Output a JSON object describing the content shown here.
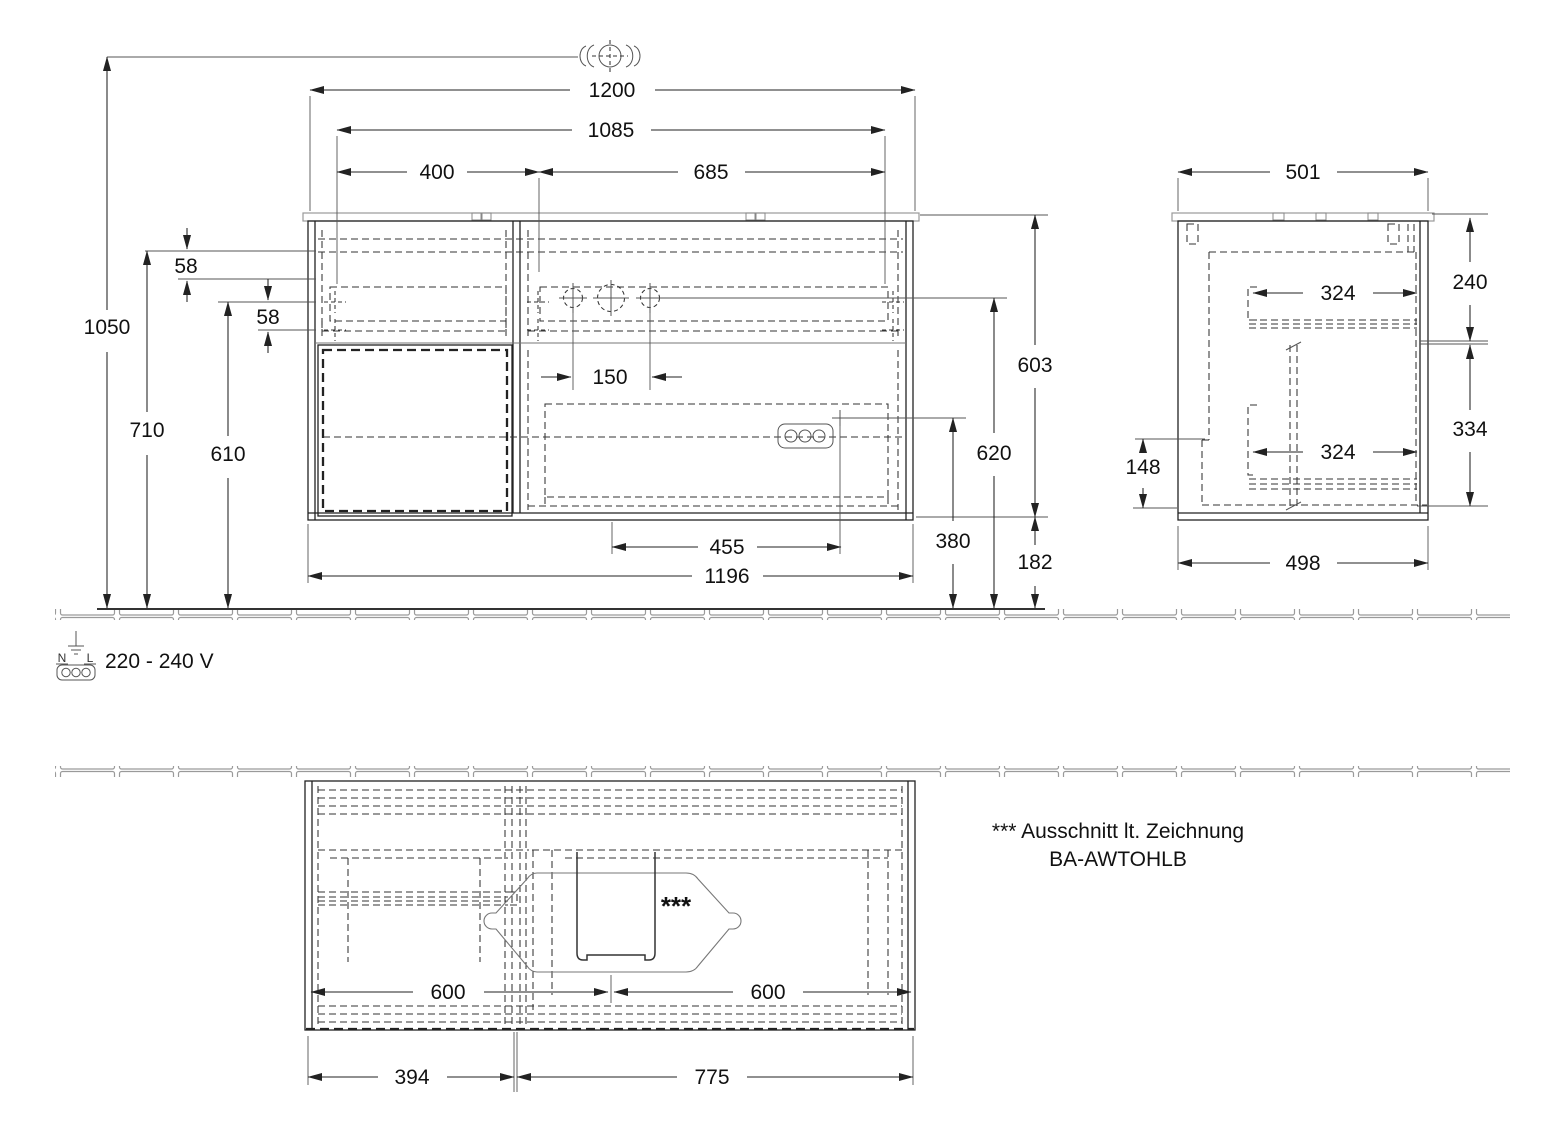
{
  "front": {
    "d1200": "1200",
    "d1085": "1085",
    "d400": "400",
    "d685": "685",
    "d1050": "1050",
    "d710": "710",
    "d610": "610",
    "d58a": "58",
    "d58b": "58",
    "d150": "150",
    "d603": "603",
    "d620": "620",
    "d380": "380",
    "d182": "182",
    "d455": "455",
    "d1196": "1196"
  },
  "side": {
    "d501": "501",
    "d324a": "324",
    "d240": "240",
    "d334": "334",
    "d324b": "324",
    "d148": "148",
    "d498": "498"
  },
  "plan": {
    "d600l": "600",
    "d600r": "600",
    "d394": "394",
    "d775": "775",
    "cutout": "***"
  },
  "power": {
    "n": "N",
    "l": "L",
    "label": "220 - 240 V"
  },
  "note": {
    "line1": "*** Ausschnitt lt. Zeichnung",
    "line2": "BA-AWTOHLB"
  }
}
